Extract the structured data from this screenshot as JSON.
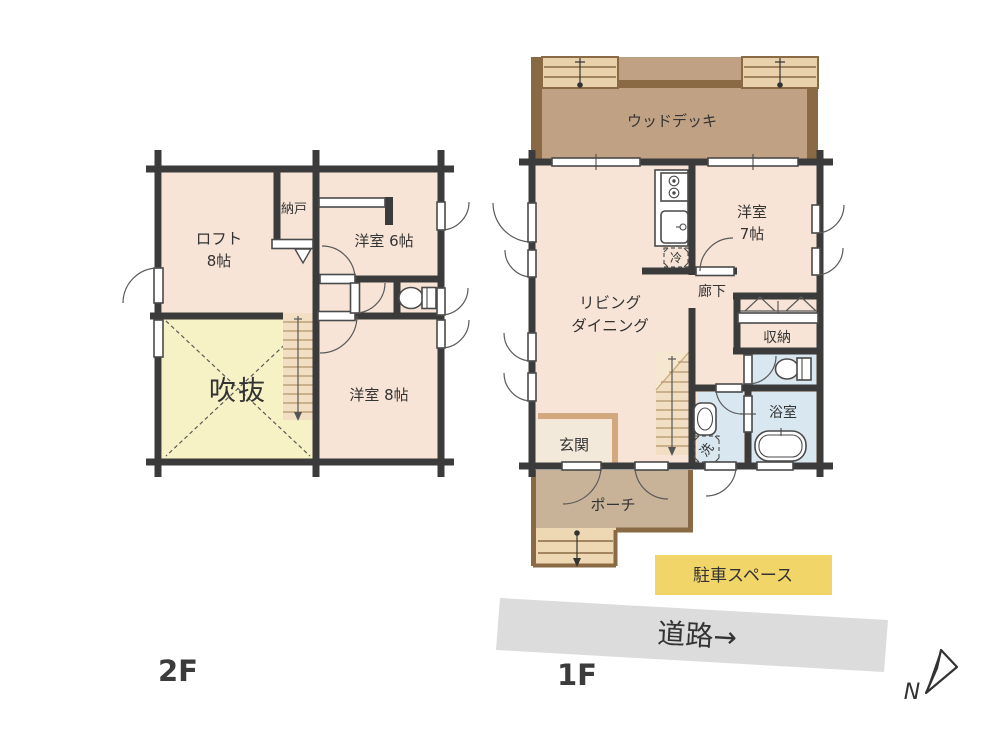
{
  "page": {
    "type": "floor-plan"
  },
  "floor2": {
    "floor_label": "2F",
    "loft_line1": "ロフト",
    "loft_line2": "8帖",
    "nando": "納戸",
    "room6": "洋室 6帖",
    "room8": "洋室 8帖",
    "atrium": "吹抜"
  },
  "floor1": {
    "floor_label": "1F",
    "deck": "ウッドデッキ",
    "room7_line1": "洋室",
    "room7_line2": "7帖",
    "living_line1": "リビング",
    "living_line2": "ダイニング",
    "hallway": "廊下",
    "closet": "収納",
    "bathroom": "浴室",
    "entrance": "玄関",
    "porch": "ポーチ",
    "fridge": "冷",
    "washer": "洗"
  },
  "site": {
    "parking": "駐車スペース",
    "road": "道路→",
    "compass_north": "N"
  },
  "colors": {
    "wall": "#3b3b3b",
    "room": "#f7e4d6",
    "atrium": "#f7f2c5",
    "stairs": "#f1dec3",
    "deck": "#c1a183",
    "deck_trim": "#8a6a44",
    "steps": "#e9d1ab",
    "porch": "#c8b298",
    "wet_room": "#d9e7f0",
    "parking": "#f2d568",
    "road": "#dcdcdc",
    "kamachi": "#d2a87e",
    "text": "#333333"
  }
}
